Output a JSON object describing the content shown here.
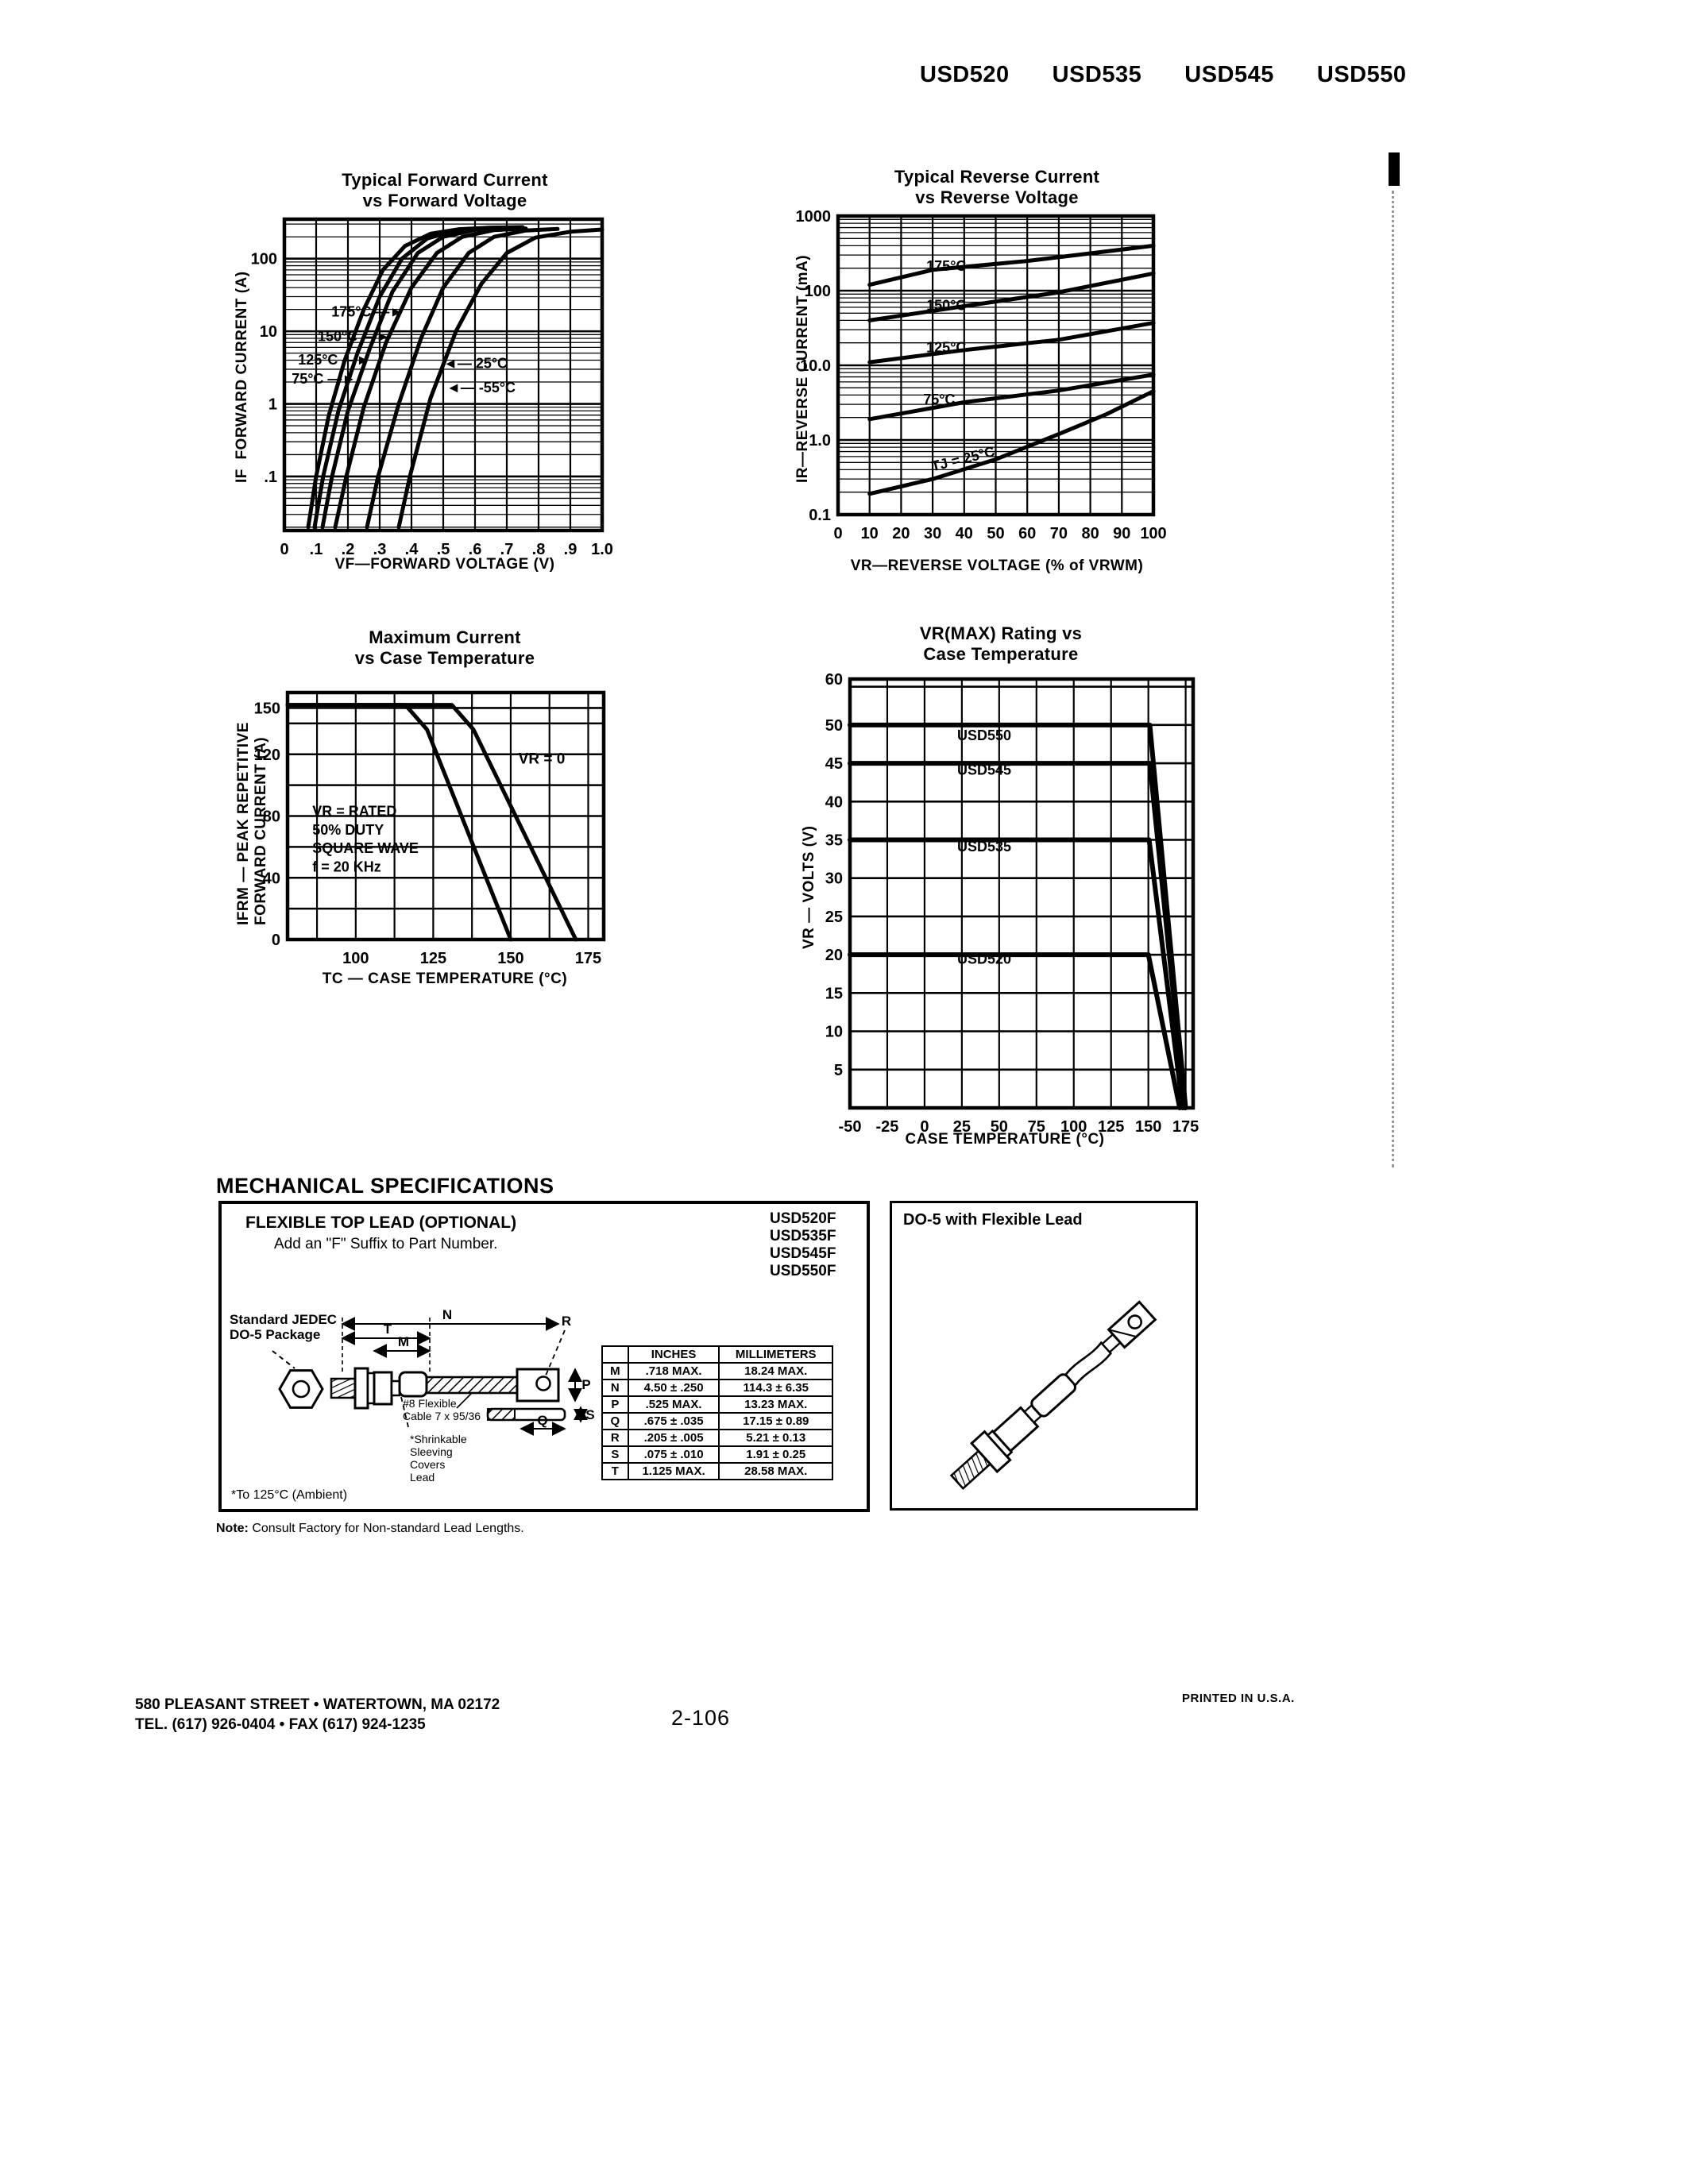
{
  "header": {
    "parts": [
      "USD520",
      "USD535",
      "USD545",
      "USD550"
    ]
  },
  "footer": {
    "address_line1": "580 PLEASANT STREET • WATERTOWN, MA 02172",
    "address_line2": "TEL. (617) 926-0404 • FAX (617) 924-1235",
    "page_number": "2-106",
    "printed": "PRINTED IN U.S.A."
  },
  "mech": {
    "heading": "MECHANICAL SPECIFICATIONS",
    "flexible_title": "FLEXIBLE TOP LEAD (OPTIONAL)",
    "flexible_sub": "Add an \"F\" Suffix to Part Number.",
    "part_numbers": [
      "USD520F",
      "USD535F",
      "USD545F",
      "USD550F"
    ],
    "jedec_label": "Standard JEDEC\nDO-5 Package",
    "cable_label": "#8 Flexible\nCable 7 x 95/36",
    "shrink_label": "*Shrinkable\nSleeving\nCovers\nLead",
    "ambient_note": "*To 125°C (Ambient)",
    "note_label": "Note:",
    "note_text": " Consult Factory for Non-standard Lead Lengths.",
    "do5_title": "DO-5 with Flexible Lead",
    "dims": {
      "m": "M",
      "n": "N",
      "p": "P",
      "q": "Q",
      "r": "R",
      "s": "S",
      "t": "T"
    },
    "table": {
      "headers": [
        "",
        "INCHES",
        "MILLIMETERS"
      ],
      "rows": [
        {
          "d": "M",
          "in": ".718 MAX.",
          "mm": "18.24 MAX."
        },
        {
          "d": "N",
          "in": "4.50 ± .250",
          "mm": "114.3 ± 6.35"
        },
        {
          "d": "P",
          "in": ".525 MAX.",
          "mm": "13.23 MAX."
        },
        {
          "d": "Q",
          "in": ".675 ± .035",
          "mm": "17.15 ± 0.89"
        },
        {
          "d": "R",
          "in": ".205 ± .005",
          "mm": "5.21 ± 0.13"
        },
        {
          "d": "S",
          "in": ".075 ± .010",
          "mm": "1.91 ± 0.25"
        },
        {
          "d": "T",
          "in": "1.125 MAX.",
          "mm": "28.58 MAX."
        }
      ]
    }
  },
  "chart_data": [
    {
      "type": "line",
      "title": "Typical Forward Current\nvs Forward Voltage",
      "xlabel": "VF—FORWARD VOLTAGE (V)",
      "ylabel": "IF  FORWARD CURRENT (A)",
      "xscale": "linear",
      "yscale": "log",
      "xlim": [
        0,
        1.0
      ],
      "ylim": [
        0.018,
        350
      ],
      "grid": "on",
      "legend_position": "none",
      "xgrid": [
        0.1,
        0.2,
        0.3,
        0.4,
        0.5,
        0.6,
        0.7,
        0.8,
        0.9
      ],
      "ygrid": [
        0.1,
        1,
        10,
        100
      ],
      "xticks": [
        {
          "v": 0,
          "label": "0"
        },
        {
          "v": 0.1,
          "label": ".1"
        },
        {
          "v": 0.2,
          "label": ".2"
        },
        {
          "v": 0.3,
          "label": ".3"
        },
        {
          "v": 0.4,
          "label": ".4"
        },
        {
          "v": 0.5,
          "label": ".5"
        },
        {
          "v": 0.6,
          "label": ".6"
        },
        {
          "v": 0.7,
          "label": ".7"
        },
        {
          "v": 0.8,
          "label": ".8"
        },
        {
          "v": 0.9,
          "label": ".9"
        },
        {
          "v": 1.0,
          "label": "1.0"
        }
      ],
      "yticks": [
        {
          "v": 100,
          "label": "100"
        },
        {
          "v": 10,
          "label": "10"
        },
        {
          "v": 1,
          "label": "1"
        },
        {
          "v": 0.1,
          "label": ".1"
        }
      ],
      "series": [
        {
          "name": "175°C",
          "points": [
            [
              0.075,
              0.02
            ],
            [
              0.1,
              0.1
            ],
            [
              0.14,
              0.7
            ],
            [
              0.19,
              4
            ],
            [
              0.25,
              20
            ],
            [
              0.31,
              70
            ],
            [
              0.38,
              150
            ],
            [
              0.46,
              220
            ],
            [
              0.55,
              255
            ],
            [
              0.65,
              268
            ],
            [
              0.75,
              272
            ]
          ]
        },
        {
          "name": "150°C",
          "points": [
            [
              0.095,
              0.02
            ],
            [
              0.122,
              0.1
            ],
            [
              0.17,
              0.8
            ],
            [
              0.23,
              5
            ],
            [
              0.3,
              30
            ],
            [
              0.37,
              100
            ],
            [
              0.45,
              190
            ],
            [
              0.54,
              245
            ],
            [
              0.64,
              262
            ],
            [
              0.72,
              266
            ]
          ]
        },
        {
          "name": "125°C",
          "points": [
            [
              0.12,
              0.02
            ],
            [
              0.15,
              0.1
            ],
            [
              0.2,
              0.8
            ],
            [
              0.27,
              6
            ],
            [
              0.34,
              35
            ],
            [
              0.42,
              120
            ],
            [
              0.5,
              200
            ],
            [
              0.6,
              250
            ],
            [
              0.7,
              262
            ]
          ]
        },
        {
          "name": "75°C",
          "points": [
            [
              0.16,
              0.02
            ],
            [
              0.195,
              0.1
            ],
            [
              0.25,
              0.9
            ],
            [
              0.32,
              7
            ],
            [
              0.4,
              40
            ],
            [
              0.48,
              120
            ],
            [
              0.56,
              200
            ],
            [
              0.66,
              248
            ],
            [
              0.76,
              260
            ]
          ]
        },
        {
          "name": "25°C",
          "points": [
            [
              0.26,
              0.02
            ],
            [
              0.295,
              0.1
            ],
            [
              0.36,
              1
            ],
            [
              0.43,
              8
            ],
            [
              0.5,
              40
            ],
            [
              0.58,
              120
            ],
            [
              0.66,
              200
            ],
            [
              0.76,
              245
            ],
            [
              0.86,
              257
            ]
          ]
        },
        {
          "name": "-55°C",
          "points": [
            [
              0.36,
              0.02
            ],
            [
              0.395,
              0.1
            ],
            [
              0.46,
              1.2
            ],
            [
              0.54,
              10
            ],
            [
              0.62,
              45
            ],
            [
              0.7,
              120
            ],
            [
              0.79,
              195
            ],
            [
              0.9,
              235
            ],
            [
              1.0,
              252
            ]
          ]
        }
      ],
      "annotations": [
        {
          "text": "175°C",
          "x": 0.148,
          "y": 16,
          "anchor": "start",
          "arrow": "r"
        },
        {
          "text": "150°C",
          "x": 0.105,
          "y": 7.3,
          "anchor": "start",
          "arrow": "r"
        },
        {
          "text": "125°C",
          "x": 0.043,
          "y": 3.5,
          "anchor": "start",
          "arrow": "r"
        },
        {
          "text": "75°C",
          "x": 0.023,
          "y": 1.9,
          "anchor": "start",
          "arrow": "r"
        },
        {
          "text": "25°C",
          "x": 0.5,
          "y": 3.1,
          "anchor": "start",
          "arrow": "l"
        },
        {
          "text": "-55°C",
          "x": 0.51,
          "y": 1.45,
          "anchor": "start",
          "arrow": "l"
        }
      ]
    },
    {
      "type": "line",
      "title": "Typical Reverse Current\nvs Reverse Voltage",
      "xlabel": "VR—REVERSE VOLTAGE (% of VRWM)",
      "ylabel": "IR—REVERSE CURRENT (mA)",
      "xscale": "linear",
      "yscale": "log",
      "xlim": [
        0,
        100
      ],
      "ylim": [
        0.1,
        1000
      ],
      "grid": "on",
      "legend_position": "none",
      "xgrid": [
        10,
        20,
        30,
        40,
        50,
        60,
        70,
        80,
        90
      ],
      "ygrid": [
        1,
        10,
        100
      ],
      "xticks": [
        {
          "v": 0,
          "label": "0"
        },
        {
          "v": 10,
          "label": "10"
        },
        {
          "v": 20,
          "label": "20"
        },
        {
          "v": 30,
          "label": "30"
        },
        {
          "v": 40,
          "label": "40"
        },
        {
          "v": 50,
          "label": "50"
        },
        {
          "v": 60,
          "label": "60"
        },
        {
          "v": 70,
          "label": "70"
        },
        {
          "v": 80,
          "label": "80"
        },
        {
          "v": 90,
          "label": "90"
        },
        {
          "v": 100,
          "label": "100"
        }
      ],
      "yticks": [
        {
          "v": 1000,
          "label": "1000"
        },
        {
          "v": 100,
          "label": "100"
        },
        {
          "v": 10,
          "label": "10.0"
        },
        {
          "v": 1,
          "label": "1.0"
        },
        {
          "v": 0.1,
          "label": "0.1"
        }
      ],
      "series": [
        {
          "name": "175°C",
          "points": [
            [
              10,
              120
            ],
            [
              30,
              190
            ],
            [
              60,
              250
            ],
            [
              100,
              400
            ]
          ]
        },
        {
          "name": "150°C",
          "points": [
            [
              10,
              40
            ],
            [
              40,
              62
            ],
            [
              70,
              95
            ],
            [
              100,
              170
            ]
          ]
        },
        {
          "name": "125°C",
          "points": [
            [
              10,
              11
            ],
            [
              40,
              16
            ],
            [
              70,
              22
            ],
            [
              100,
              37
            ]
          ]
        },
        {
          "name": "75°C",
          "points": [
            [
              10,
              1.9
            ],
            [
              40,
              3.2
            ],
            [
              70,
              4.6
            ],
            [
              100,
              7.5
            ]
          ]
        },
        {
          "name": "TJ = 25°C",
          "points": [
            [
              10,
              0.19
            ],
            [
              30,
              0.3
            ],
            [
              50,
              0.55
            ],
            [
              70,
              1.2
            ],
            [
              85,
              2.2
            ],
            [
              100,
              4.5
            ]
          ]
        }
      ],
      "annotations": [
        {
          "text": "175°C",
          "x": 28,
          "y": 185,
          "anchor": "start"
        },
        {
          "text": "150°C",
          "x": 28,
          "y": 55,
          "anchor": "start"
        },
        {
          "text": "125°C",
          "x": 28,
          "y": 15,
          "anchor": "start"
        },
        {
          "text": "75°C",
          "x": 27,
          "y": 3.0,
          "anchor": "start"
        },
        {
          "text": "TJ = 25°C",
          "x": 30,
          "y": 0.38,
          "anchor": "start",
          "rot": -14
        }
      ]
    },
    {
      "type": "line",
      "title": "Maximum Current\nvs Case Temperature",
      "xlabel": "TC — CASE TEMPERATURE (°C)",
      "ylabel": "IFRM — PEAK REPETITIVE\nFORWARD CURRENT (A)",
      "xscale": "linear",
      "yscale": "linear",
      "xlim": [
        78,
        180
      ],
      "ylim": [
        0,
        160
      ],
      "grid": "on",
      "legend_position": "none",
      "xgrid": [
        87.5,
        100,
        112.5,
        125,
        137.5,
        150,
        162.5,
        175
      ],
      "ygrid": [
        20,
        40,
        60,
        80,
        100,
        120,
        140,
        150
      ],
      "xticks": [
        {
          "v": 100,
          "label": "100"
        },
        {
          "v": 125,
          "label": "125"
        },
        {
          "v": 150,
          "label": "150"
        },
        {
          "v": 175,
          "label": "175"
        }
      ],
      "yticks": [
        {
          "v": 0,
          "label": "0"
        },
        {
          "v": 40,
          "label": "40"
        },
        {
          "v": 80,
          "label": "80"
        },
        {
          "v": 120,
          "label": "120"
        },
        {
          "v": 150,
          "label": "150"
        }
      ],
      "series": [
        {
          "name": "VR = RATED",
          "points": [
            [
              78,
              152
            ],
            [
              116,
              152
            ],
            [
              123,
              136
            ],
            [
              150,
              0
            ]
          ]
        },
        {
          "name": "VR = 0",
          "points": [
            [
              78,
              152
            ],
            [
              131,
              152
            ],
            [
              138,
              136
            ],
            [
              171,
              0
            ]
          ]
        }
      ],
      "annotations": [
        {
          "text": "VR = 0",
          "x": 160,
          "y": 114,
          "anchor": "middle",
          "fs": 19
        },
        {
          "text": "VR = RATED",
          "x": 86,
          "y": 80,
          "anchor": "start"
        },
        {
          "text": "50% DUTY",
          "x": 86,
          "y": 68,
          "anchor": "start"
        },
        {
          "text": "SQUARE WAVE",
          "x": 86,
          "y": 56,
          "anchor": "start"
        },
        {
          "text": "f = 20 KHz",
          "x": 86,
          "y": 44,
          "anchor": "start"
        }
      ]
    },
    {
      "type": "line",
      "title": "VR(MAX) Rating vs\nCase Temperature",
      "xlabel": "CASE TEMPERATURE (°C)",
      "ylabel": "VR — VOLTS (V)",
      "xscale": "linear",
      "yscale": "linear",
      "xlim": [
        -50,
        180
      ],
      "ylim": [
        0,
        56
      ],
      "grid": "on",
      "legend_position": "none",
      "xgrid": [
        -25,
        0,
        25,
        50,
        75,
        100,
        125,
        150,
        175
      ],
      "ygrid": [
        5,
        10,
        15,
        20,
        25,
        30,
        35,
        40,
        45,
        50,
        55
      ],
      "xticks": [
        {
          "v": -50,
          "label": "-50"
        },
        {
          "v": -25,
          "label": "-25"
        },
        {
          "v": 0,
          "label": "0"
        },
        {
          "v": 25,
          "label": "25"
        },
        {
          "v": 50,
          "label": "50"
        },
        {
          "v": 75,
          "label": "75"
        },
        {
          "v": 100,
          "label": "100"
        },
        {
          "v": 125,
          "label": "125"
        },
        {
          "v": 150,
          "label": "150"
        },
        {
          "v": 175,
          "label": "175"
        }
      ],
      "yticks": [
        {
          "v": 56,
          "label": "60"
        },
        {
          "v": 50,
          "label": "50"
        },
        {
          "v": 45,
          "label": "45"
        },
        {
          "v": 40,
          "label": "40"
        },
        {
          "v": 35,
          "label": "35"
        },
        {
          "v": 30,
          "label": "30"
        },
        {
          "v": 25,
          "label": "25"
        },
        {
          "v": 20,
          "label": "20"
        },
        {
          "v": 15,
          "label": "15"
        },
        {
          "v": 10,
          "label": "10"
        },
        {
          "v": 5,
          "label": "5"
        }
      ],
      "series": [
        {
          "name": "USD550",
          "points": [
            [
              -50,
              50
            ],
            [
              151,
              50
            ],
            [
              175,
              0
            ]
          ],
          "lw": 6
        },
        {
          "name": "USD545",
          "points": [
            [
              -50,
              45
            ],
            [
              151,
              45
            ],
            [
              174.5,
              0
            ]
          ],
          "lw": 6
        },
        {
          "name": "USD535",
          "points": [
            [
              -50,
              35
            ],
            [
              150.5,
              35
            ],
            [
              173,
              0
            ]
          ],
          "lw": 6
        },
        {
          "name": "USD520",
          "points": [
            [
              -50,
              20
            ],
            [
              150,
              20
            ],
            [
              171,
              0
            ]
          ],
          "lw": 6
        }
      ],
      "annotations": [
        {
          "text": "USD550",
          "x": 40,
          "y": 48,
          "anchor": "middle"
        },
        {
          "text": "USD545",
          "x": 40,
          "y": 43.5,
          "anchor": "middle"
        },
        {
          "text": "USD535",
          "x": 40,
          "y": 33.5,
          "anchor": "middle"
        },
        {
          "text": "USD520",
          "x": 40,
          "y": 18.8,
          "anchor": "middle"
        }
      ]
    }
  ]
}
